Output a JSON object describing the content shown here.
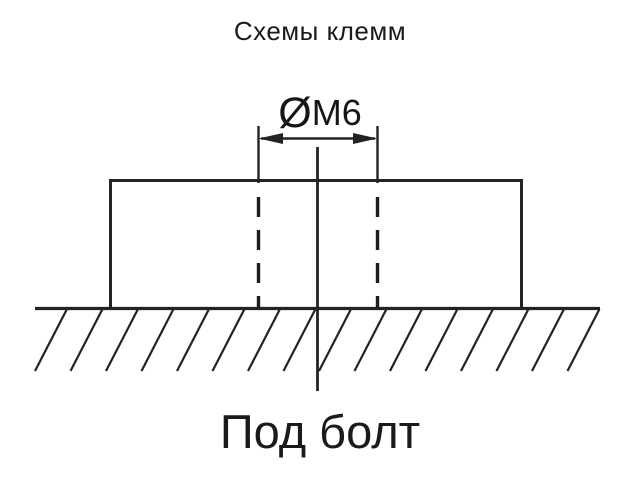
{
  "page": {
    "background_color": "#ffffff",
    "line_color": "#232323",
    "text_color": "#1a1a1a"
  },
  "title": {
    "text": "Схемы клемм"
  },
  "diagram": {
    "dimension_label": {
      "symbol": "Ø",
      "text": "M6"
    },
    "caption": "Под болт",
    "parts": {
      "body": "terminal body cross-section rectangle",
      "hole": "hidden dashed lines for M6 bolt hole",
      "ground": "hatched mounting surface"
    }
  }
}
